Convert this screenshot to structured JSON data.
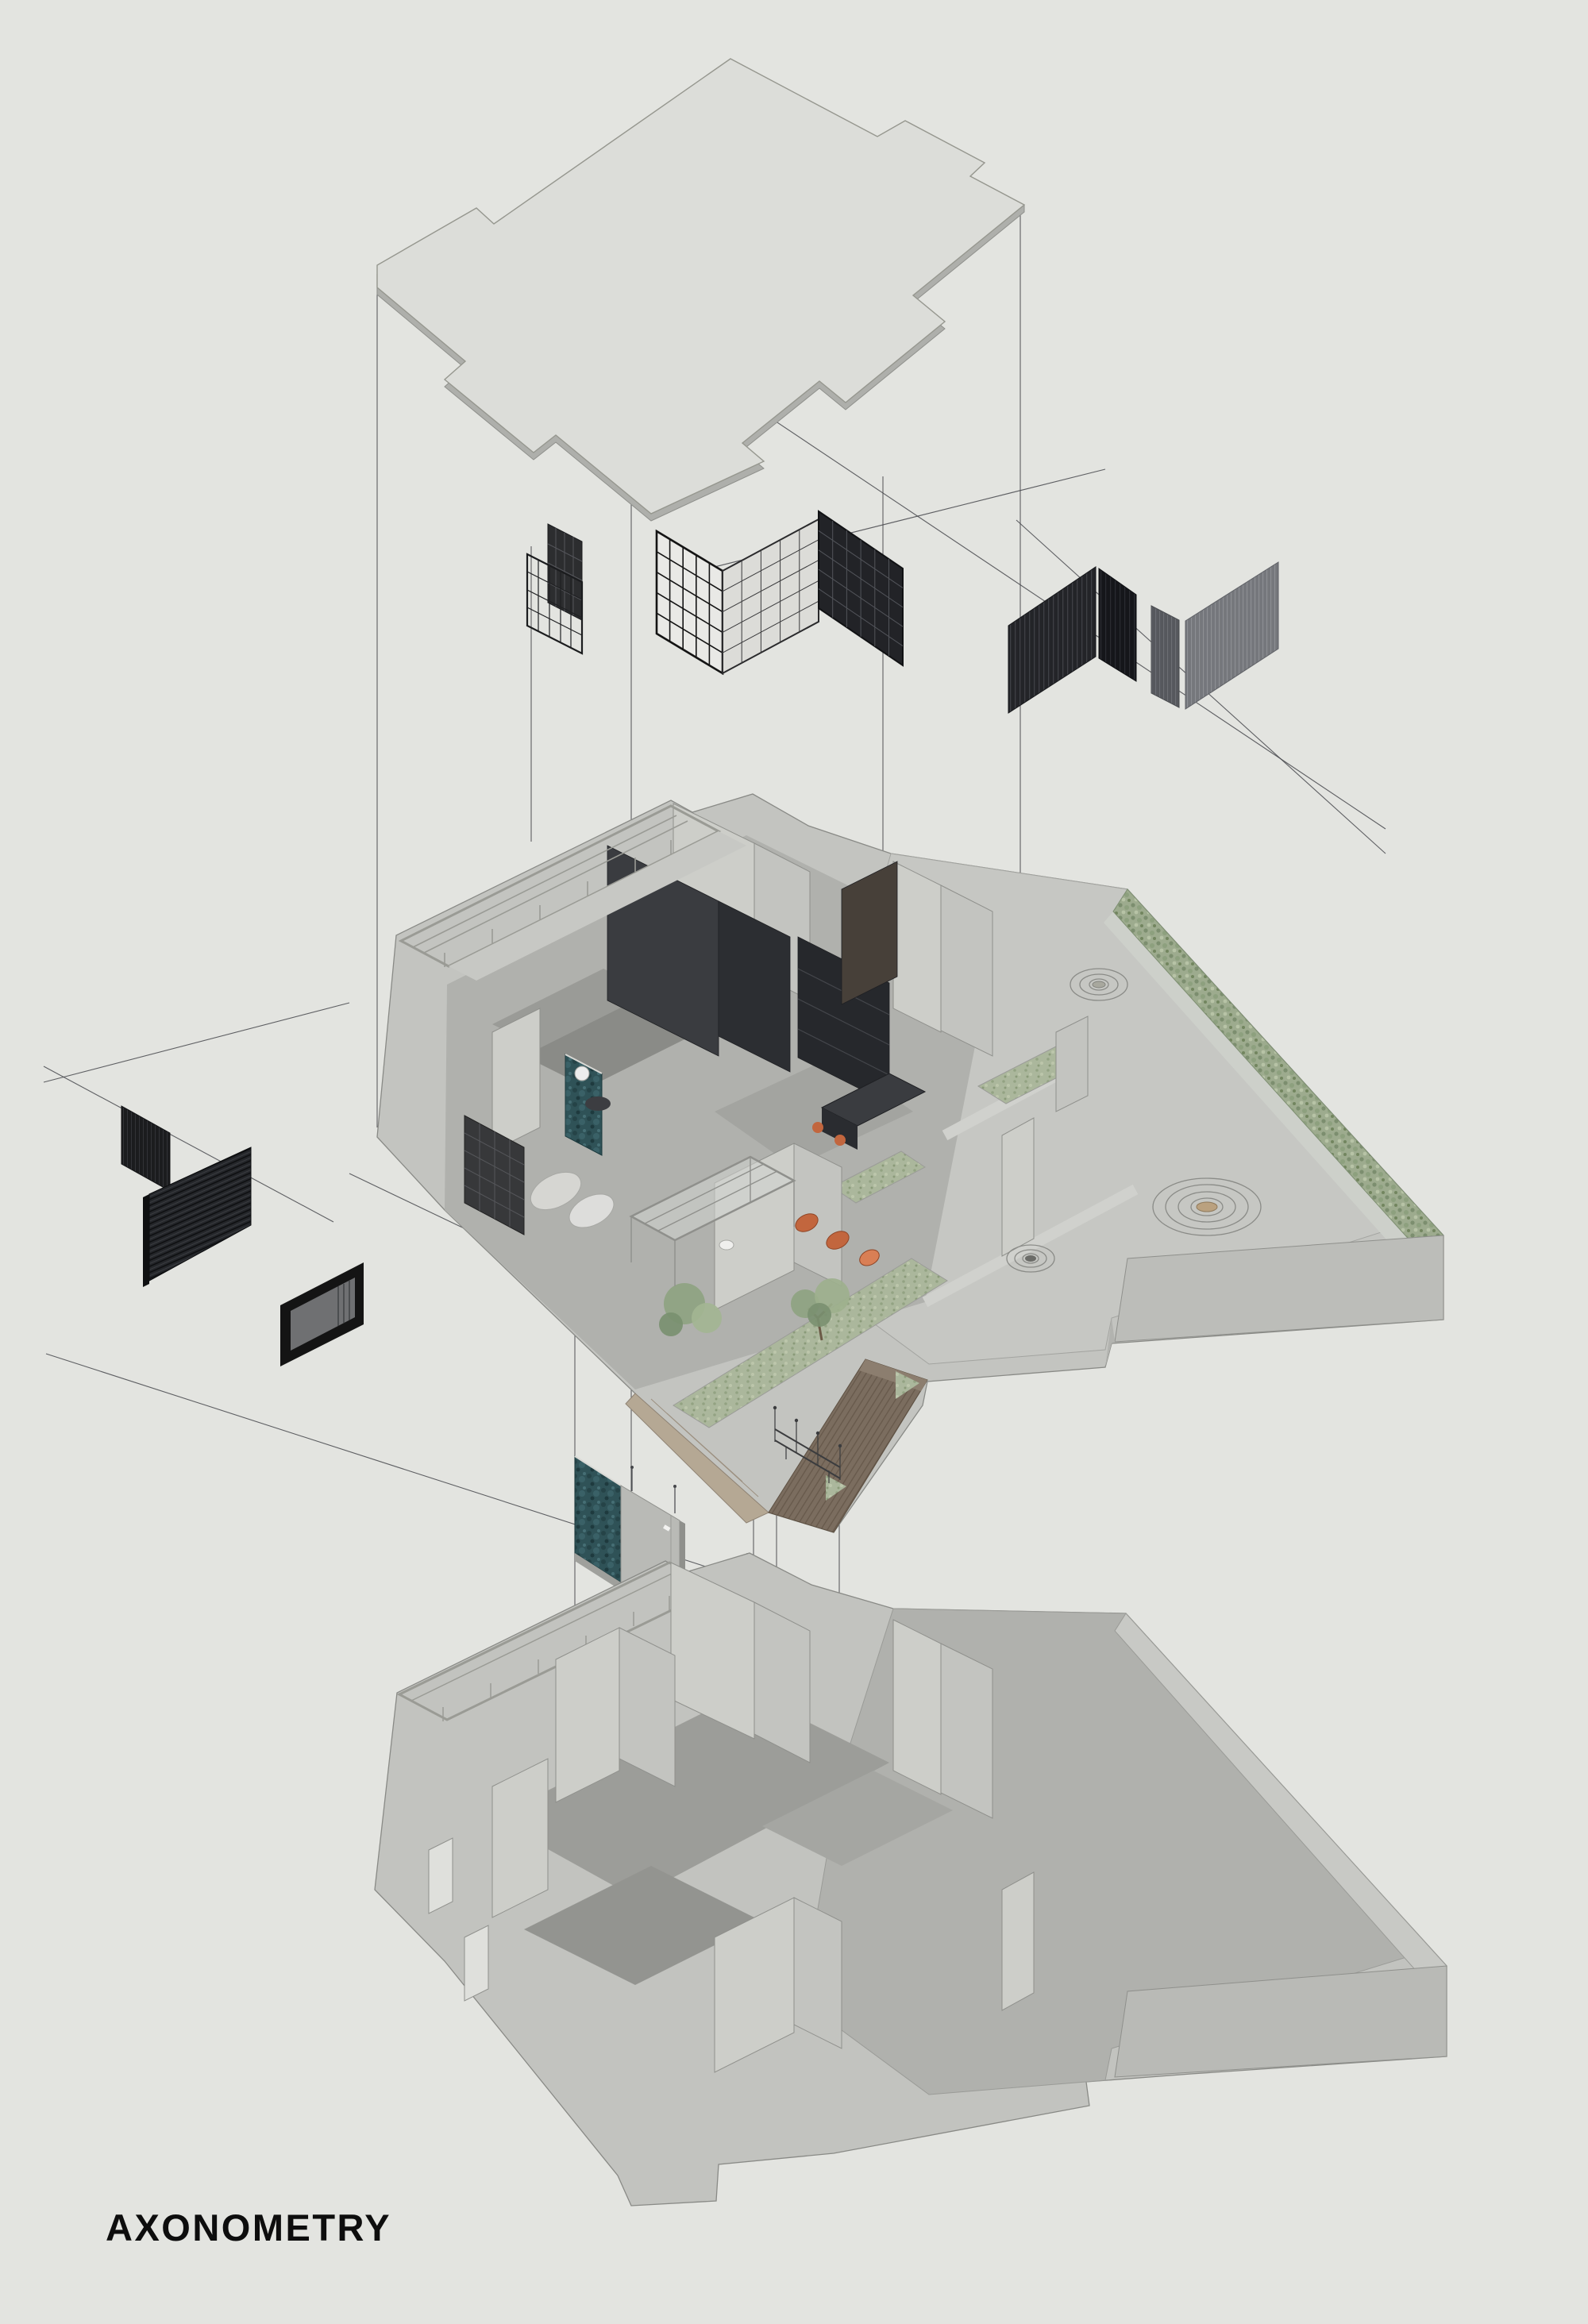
{
  "title": {
    "label": "AXONOMETRY"
  },
  "palette": {
    "background": "#e3e4e0",
    "roof_fill": "#dcddd9",
    "roof_edge": "#96978f",
    "roof_thickness": "#aeafab",
    "construction_line": "#47484c",
    "screen_dark": "#232428",
    "screen_black": "#15161a",
    "screen_gray": "#75777c",
    "grid_frame": "#141414",
    "teal_marble": "#2f5257",
    "hedge_green": "#9dab8e",
    "grass_green": "#abb79c",
    "tree_green": "#8ea381",
    "accent_orange": "#c2663e",
    "wood_brown": "#7b6d5f",
    "slab_gray": "#c3c4c0",
    "wall_gray": "#cdcec9",
    "floor_gray": "#9c9d99",
    "paving_gray": "#c6c7c3",
    "tub_white": "#f6f6f4",
    "handle_bronze": "#caa27e",
    "title_color": "#0d0d0d"
  },
  "layers": [
    {
      "id": "roof-plan",
      "role": "exploded roof slab outline"
    },
    {
      "id": "screen-partitions",
      "role": "metal grid and louver screens"
    },
    {
      "id": "furnished-floor",
      "role": "furnished floor plate with courtyard garden"
    },
    {
      "id": "exploded-fixtures",
      "role": "feature wall, door, bathtub, shelf rack"
    },
    {
      "id": "structural-floor",
      "role": "bare structural floor plate"
    }
  ]
}
